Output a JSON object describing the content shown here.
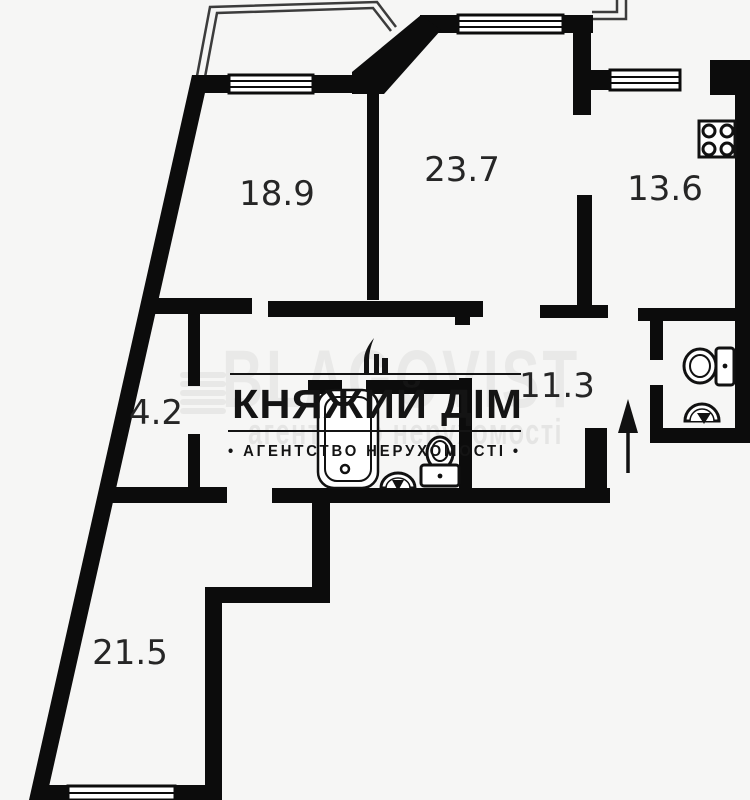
{
  "plan": {
    "background_color": "#f6f6f5",
    "wall_color": "#0c0c0c",
    "rooms": [
      {
        "name": "room-top-left",
        "area": "18.9"
      },
      {
        "name": "room-top-middle",
        "area": "23.7"
      },
      {
        "name": "kitchen",
        "area": "13.6"
      },
      {
        "name": "closet",
        "area": "4.2"
      },
      {
        "name": "hallway",
        "area": "11.3"
      },
      {
        "name": "room-bottom-left",
        "area": "21.5"
      }
    ],
    "fixtures": [
      {
        "name": "stove"
      },
      {
        "name": "bathtub"
      },
      {
        "name": "bathroom-sink"
      },
      {
        "name": "bathroom-toilet"
      },
      {
        "name": "wc-toilet"
      },
      {
        "name": "wc-sink"
      },
      {
        "name": "entrance-arrow"
      }
    ]
  },
  "watermark": {
    "brand": "КНЯЖИЙ ДІМ",
    "tagline": "• АГЕНТСТВО НЕРУХОМОСТІ •",
    "background_brand": "BLAGOVIST",
    "background_tagline": "агентство нерухомості"
  }
}
